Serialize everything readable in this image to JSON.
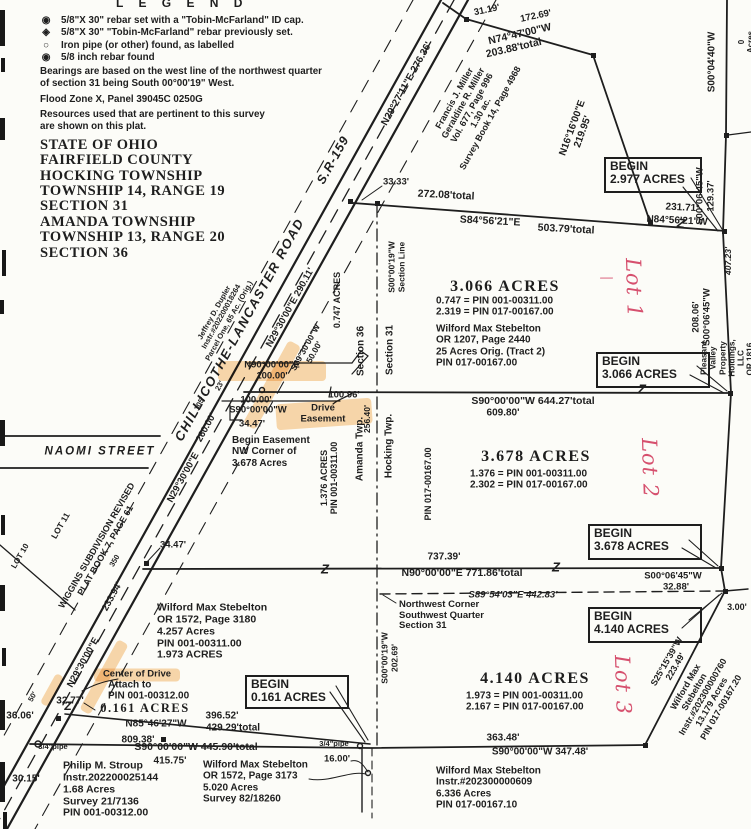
{
  "colors": {
    "paper": "#fcfcf8",
    "ink": "#1e1e1e",
    "red": "#d6506e",
    "highlight": "#f0a23c"
  },
  "legend": {
    "title": "L E G E N D",
    "items": [
      {
        "symbol": "◉",
        "text": "5/8\"X 30\" rebar set with a \"Tobin-McFarland\" ID cap."
      },
      {
        "symbol": "◈",
        "text": "5/8\"X 30\" \"Tobin-McFarland\" rebar previously set."
      },
      {
        "symbol": "○",
        "text": "Iron pipe (or other) found, as labelled"
      },
      {
        "symbol": "◉",
        "text": "5/8 inch rebar found"
      }
    ]
  },
  "notes": {
    "bearings": "Bearings are based on the west line of the northwest quarter\nof section 31 being South 00°00'19\" West.",
    "flood": "Flood Zone X, Panel 39045C 0250G",
    "resources": "Resources used that are pertinent to this survey\nare shown on this plat."
  },
  "title_block": {
    "text": "STATE OF OHIO\nFAIRFIELD COUNTY\nHOCKING TOWNSHIP\nTOWNSHIP 14, RANGE 19\nSECTION 31\nAMANDA TOWNSHIP\nTOWNSHIP 13, RANGE 20\nSECTION 36"
  },
  "map": {
    "begin_boxes": [
      {
        "label": "BEGIN",
        "acres": "2.977 ACRES",
        "x": 604,
        "y": 157,
        "w": 86,
        "h": 30
      },
      {
        "label": "BEGIN",
        "acres": "3.066 ACRES",
        "x": 596,
        "y": 352,
        "w": 102,
        "h": 30
      },
      {
        "label": "BEGIN",
        "acres": "3.678 ACRES",
        "x": 588,
        "y": 524,
        "w": 102,
        "h": 30
      },
      {
        "label": "BEGIN",
        "acres": "4.140 ACRES",
        "x": 588,
        "y": 607,
        "w": 102,
        "h": 30
      },
      {
        "label": "BEGIN",
        "acres": "0.161 ACRES",
        "x": 245,
        "y": 675,
        "w": 92,
        "h": 28
      }
    ],
    "highlights": [
      {
        "x": 272,
        "y": 371,
        "w": 108,
        "h": 20,
        "r": 0
      },
      {
        "x": 272,
        "y": 385,
        "w": 95,
        "h": 14,
        "r": -61
      },
      {
        "x": 324,
        "y": 414,
        "w": 96,
        "h": 26,
        "r": -4
      },
      {
        "x": 137,
        "y": 675,
        "w": 86,
        "h": 13,
        "r": 0
      },
      {
        "x": 104,
        "y": 677,
        "w": 80,
        "h": 12,
        "r": -61
      },
      {
        "x": 52,
        "y": 690,
        "w": 34,
        "h": 9,
        "r": -61
      }
    ],
    "labels": [
      {
        "n": "distance-label",
        "t": "31.19'",
        "x": 487,
        "y": 11,
        "r": -12,
        "s": 9.5
      },
      {
        "n": "distance-label",
        "t": "172.69'",
        "x": 536,
        "y": 17,
        "r": -12,
        "s": 9.5
      },
      {
        "n": "bearing-label",
        "t": "N74°47'00\"W",
        "x": 520,
        "y": 35,
        "r": -13,
        "s": 10.5
      },
      {
        "n": "distance-label",
        "t": "203.88'total",
        "x": 514,
        "y": 49,
        "r": -13,
        "s": 10.5
      },
      {
        "n": "bearing-label",
        "t": "N29°27'11\"E      276.36'",
        "x": 407,
        "y": 84,
        "r": -61,
        "s": 10
      },
      {
        "n": "bearing-label",
        "t": "N16°16'00\"E\n219.95'",
        "x": 578,
        "y": 130,
        "r": -70,
        "s": 10
      },
      {
        "n": "bearing-label",
        "t": "S00°04'40\"W",
        "x": 712,
        "y": 62,
        "r": -90,
        "s": 10
      },
      {
        "n": "partial-label",
        "t": "0 Acres",
        "x": 746,
        "y": 42,
        "r": -90,
        "s": 8
      },
      {
        "n": "owner-parcel-block",
        "t": "Francis J. Miller\nGeraldine R. Miller\nVol. 677, Page 996\n1.30 ac.\nSurvey Book 14, Page 4968",
        "x": 472,
        "y": 108,
        "r": -61,
        "s": 9
      },
      {
        "n": "distance-label",
        "t": "33.33'",
        "x": 396,
        "y": 183,
        "s": 9.5
      },
      {
        "n": "distance-label",
        "t": "272.08'total",
        "x": 446,
        "y": 196,
        "r": 3,
        "s": 10.5
      },
      {
        "n": "bearing-label",
        "t": "S84°56'21\"E",
        "x": 490,
        "y": 222,
        "r": 3,
        "s": 10.5
      },
      {
        "n": "distance-label",
        "t": "503.79'total",
        "x": 566,
        "y": 230,
        "r": 3,
        "s": 10.5
      },
      {
        "n": "distance-label",
        "t": "231.71'",
        "x": 682,
        "y": 208,
        "r": 3,
        "s": 10
      },
      {
        "n": "bearing-label",
        "t": "N84°56'21\"W",
        "x": 677,
        "y": 221,
        "r": 3,
        "s": 10
      },
      {
        "n": "bearing-label",
        "t": "S00°06'45\"W\n129.37'",
        "x": 706,
        "y": 196,
        "r": -90,
        "s": 9.5
      },
      {
        "n": "distance-label",
        "t": "407.23'",
        "x": 729,
        "y": 261,
        "r": -90,
        "s": 8.5,
        "cls": "it"
      },
      {
        "n": "bearing-label",
        "t": "208.06'\nS00°06'45\"W",
        "x": 702,
        "y": 317,
        "r": -90,
        "s": 9.5
      },
      {
        "n": "owner-parcel-block",
        "t": "Pleasant Valley Property Holdings, LLC\nOR 1816, Page 780  103.056 Acres",
        "x": 741,
        "y": 358,
        "r": -90,
        "s": 8.2
      },
      {
        "n": "parcel-acreage",
        "t": "3.066 ACRES",
        "x": 505,
        "y": 287,
        "s": 16,
        "cls": "acre"
      },
      {
        "n": "pin-equation",
        "t": "0.747  =  PIN 001-00311.00\n2.319  =  PIN 017-00167.00",
        "x": 436,
        "y": 307,
        "al": "l",
        "s": 10
      },
      {
        "n": "owner-parcel-block",
        "t": "Wilford Max Stebelton\nOR 1207, Page 2440\n25 Acres Orig. (Tract 2)\nPIN 017-00167.00",
        "x": 436,
        "y": 346,
        "al": "l",
        "s": 10
      },
      {
        "n": "bearing-label",
        "t": "S90°00'00\"W    644.27'total",
        "x": 533,
        "y": 402,
        "s": 10.5
      },
      {
        "n": "distance-label",
        "t": "609.80'",
        "x": 503,
        "y": 413,
        "s": 10
      },
      {
        "n": "distance-label",
        "t": "100.96'",
        "x": 344,
        "y": 396,
        "s": 9.5
      },
      {
        "n": "easement-label",
        "t": "N90°00'00\"E\n100.00'",
        "x": 272,
        "y": 371,
        "s": 9.5
      },
      {
        "n": "easement-label",
        "t": "S29°30'00\"W\n50.00'",
        "x": 310,
        "y": 350,
        "r": -61,
        "s": 8.5
      },
      {
        "n": "distance-label",
        "t": "100.00'",
        "x": 256,
        "y": 401,
        "s": 9.5
      },
      {
        "n": "bearing-label",
        "t": "S90°00'00\"W",
        "x": 258,
        "y": 411,
        "s": 9.5
      },
      {
        "n": "distance-label",
        "t": "34.47'",
        "x": 252,
        "y": 425,
        "s": 9.5
      },
      {
        "n": "easement-label",
        "t": "Drive\nEasement",
        "x": 323,
        "y": 414,
        "s": 9.5
      },
      {
        "n": "begin-easement-note",
        "t": "Begin Easement\nNW Corner of\n3.678 Acres",
        "x": 232,
        "y": 452,
        "al": "l",
        "s": 10
      },
      {
        "n": "acreage-label",
        "t": "0.747 ACRES",
        "x": 337,
        "y": 300,
        "r": -90,
        "s": 9
      },
      {
        "n": "section-label",
        "t": "Section 36",
        "x": 361,
        "y": 351,
        "r": -90,
        "s": 10
      },
      {
        "n": "section-label",
        "t": "Section 31",
        "x": 390,
        "y": 350,
        "r": -90,
        "s": 10
      },
      {
        "n": "section-line-label",
        "t": "S00°00'19\"W\nSection Line",
        "x": 397,
        "y": 267,
        "r": -90,
        "s": 8.5
      },
      {
        "n": "township-label",
        "t": "Amanda Twp.",
        "x": 360,
        "y": 449,
        "r": -90,
        "s": 10
      },
      {
        "n": "township-label",
        "t": "Hocking Twp.",
        "x": 389,
        "y": 446,
        "r": -90,
        "s": 10
      },
      {
        "n": "acreage-label",
        "t": "1.376 ACRES\nPIN 001-00311.00",
        "x": 329,
        "y": 478,
        "r": -90,
        "s": 9
      },
      {
        "n": "distance-label",
        "t": "256.40'",
        "x": 368,
        "y": 419,
        "r": -90,
        "s": 8.5
      },
      {
        "n": "pin-label",
        "t": "PIN 017-00167.00",
        "x": 428,
        "y": 484,
        "r": -90,
        "s": 9
      },
      {
        "n": "parcel-acreage",
        "t": "3.678 ACRES",
        "x": 536,
        "y": 457,
        "s": 16,
        "cls": "acre"
      },
      {
        "n": "pin-equation",
        "t": "1.376  =  PIN 001-00311.00\n2.302  =  PIN 017-00167.00",
        "x": 470,
        "y": 480,
        "al": "l",
        "s": 10
      },
      {
        "n": "distance-label",
        "t": "737.39'",
        "x": 444,
        "y": 557,
        "s": 10
      },
      {
        "n": "bearing-label",
        "t": "N90°00'00\"E    771.86'total",
        "x": 462,
        "y": 574,
        "s": 10.5
      },
      {
        "n": "bearing-label",
        "t": "S00°06'45\"W",
        "x": 673,
        "y": 577,
        "s": 9.5
      },
      {
        "n": "distance-label",
        "t": "32.88'",
        "x": 676,
        "y": 588,
        "s": 9.5
      },
      {
        "n": "bearing-label",
        "t": "S89°54'03\"E    442.83'",
        "x": 513,
        "y": 596,
        "s": 9.5,
        "cls": "it"
      },
      {
        "n": "corner-note",
        "t": "Northwest Corner\nSouthwest Quarter\nSection 31",
        "x": 399,
        "y": 616,
        "al": "l",
        "s": 9.5
      },
      {
        "n": "parcel-acreage",
        "t": "4.140 ACRES",
        "x": 535,
        "y": 679,
        "s": 16,
        "cls": "acre"
      },
      {
        "n": "pin-equation",
        "t": "1.973  =  PIN 001-00311.00\n2.167  =  PIN 017-00167.00",
        "x": 466,
        "y": 702,
        "al": "l",
        "s": 10
      },
      {
        "n": "distance-label",
        "t": "363.48'",
        "x": 503,
        "y": 738,
        "s": 10
      },
      {
        "n": "bearing-label",
        "t": "S90°00'00\"W    347.48'",
        "x": 540,
        "y": 752,
        "s": 10
      },
      {
        "n": "owner-parcel-block",
        "t": "Wilford Max Stebelton\nInstr.#202300000609\n6.336 Acres\nPIN 017-00167.10",
        "x": 436,
        "y": 788,
        "al": "l",
        "s": 10
      },
      {
        "n": "bearing-label",
        "t": "S25°15'39\"W\n223.49'",
        "x": 671,
        "y": 664,
        "r": -60,
        "s": 9
      },
      {
        "n": "owner-parcel-block",
        "t": "Wilford Max Stebelton\nInstr.#202300000760\n13.179 Acres\nPIN 017-00167.20",
        "x": 703,
        "y": 697,
        "r": -60,
        "s": 9
      },
      {
        "n": "distance-label",
        "t": "3.00'",
        "x": 737,
        "y": 607,
        "s": 9
      },
      {
        "n": "distance-label",
        "t": "16.00'",
        "x": 337,
        "y": 760,
        "s": 9.5
      },
      {
        "n": "pipe-label",
        "t": "3/4\"pipe",
        "x": 53,
        "y": 747,
        "s": 7.5
      },
      {
        "n": "pipe-label",
        "t": "3/4\"pipe",
        "x": 334,
        "y": 744,
        "s": 7.5
      },
      {
        "n": "distance-label",
        "t": "36.06'",
        "x": 20,
        "y": 716,
        "s": 10
      },
      {
        "n": "distance-label",
        "t": "30.15'",
        "x": 26,
        "y": 779,
        "s": 10
      },
      {
        "n": "distance-label",
        "t": "32.77'",
        "x": 70,
        "y": 701,
        "s": 10
      },
      {
        "n": "distance-label",
        "t": "809.38'",
        "x": 138,
        "y": 740,
        "s": 10
      },
      {
        "n": "bearing-label",
        "t": "S90°00'00\"W   445.90'total",
        "x": 196,
        "y": 748,
        "s": 10.5
      },
      {
        "n": "distance-label",
        "t": "415.75'",
        "x": 170,
        "y": 761,
        "s": 10
      },
      {
        "n": "bearing-label",
        "t": "N85°46'27\"W",
        "x": 156,
        "y": 724,
        "s": 10
      },
      {
        "n": "distance-label",
        "t": "396.52'",
        "x": 222,
        "y": 716,
        "s": 10
      },
      {
        "n": "distance-label",
        "t": "429.29'total",
        "x": 233,
        "y": 728,
        "s": 10
      },
      {
        "n": "owner-parcel-block",
        "t": "Philip M. Stroup\nInstr.202200025144\n1.68 Acres\nSurvey 21/7136\nPIN 001-00312.00",
        "x": 63,
        "y": 790,
        "al": "l",
        "s": 10.5
      },
      {
        "n": "owner-parcel-block",
        "t": "Wilford Max Stebelton\nOR 1572, Page 3173\n5.020 Acres\nSurvey 82/18260",
        "x": 203,
        "y": 782,
        "al": "l",
        "s": 10
      },
      {
        "n": "drive-note",
        "t": "Center of Drive",
        "x": 137,
        "y": 675,
        "s": 9.5
      },
      {
        "n": "drive-note",
        "t": "Attach to\nPIN 001-00312.00",
        "x": 108,
        "y": 691,
        "al": "l",
        "s": 10
      },
      {
        "n": "parcel-acreage",
        "t": "0.161 ACRES",
        "x": 145,
        "y": 708,
        "s": 12.5,
        "cls": "acre"
      },
      {
        "n": "street-name",
        "t": "NAOMI STREET",
        "x": 100,
        "y": 452,
        "s": 11.5,
        "cls": "it",
        "ls": 2
      },
      {
        "n": "lot-label",
        "t": "LOT 11",
        "x": 61,
        "y": 526,
        "r": -60,
        "s": 8.5
      },
      {
        "n": "subdivision-label",
        "t": "WIGGINS SUBDIVISION REVISED\nPLAT BOOK 7, PAGE 61",
        "x": 101,
        "y": 548,
        "r": -60,
        "s": 9
      },
      {
        "n": "lot-label",
        "t": "LOT 10",
        "x": 20,
        "y": 556,
        "r": -60,
        "s": 8
      },
      {
        "n": "distance-label",
        "t": "350",
        "x": 115,
        "y": 561,
        "r": -60,
        "s": 7.5
      },
      {
        "n": "distance-label",
        "t": "34.47'",
        "x": 173,
        "y": 546,
        "s": 9.5
      },
      {
        "n": "owner-parcel-block",
        "t": "Wilford Max Stebelton\nOR 1572, Page 3180\n4.257 Acres\nPIN 001-00311.00\n    1.973 ACRES",
        "x": 157,
        "y": 632,
        "al": "l",
        "s": 10.5
      },
      {
        "n": "road-name",
        "t": "CHILLICOTHE-LANCASTER ROAD",
        "x": 240,
        "y": 330,
        "r": -61,
        "s": 13,
        "cls": "it",
        "ls": 1.5
      },
      {
        "n": "road-name",
        "t": "S.R-159",
        "x": 333,
        "y": 160,
        "r": -61,
        "s": 12.5,
        "cls": "it",
        "ls": 1
      },
      {
        "n": "bearing-label",
        "t": "N29°30'00\"E   290.11'",
        "x": 291,
        "y": 308,
        "r": -61,
        "s": 9.5
      },
      {
        "n": "distance-label",
        "t": "260.00'",
        "x": 207,
        "y": 428,
        "r": -61,
        "s": 9.5
      },
      {
        "n": "bearing-label",
        "t": "N29°30'00\"E",
        "x": 184,
        "y": 478,
        "r": -61,
        "s": 9.5
      },
      {
        "n": "distance-label",
        "t": "233.94'",
        "x": 113,
        "y": 597,
        "r": -61,
        "s": 9.5
      },
      {
        "n": "bearing-label",
        "t": "N29°30'00\"E",
        "x": 84,
        "y": 663,
        "r": -61,
        "s": 9.5
      },
      {
        "n": "distance-label",
        "t": "50'",
        "x": 33,
        "y": 697,
        "r": -61,
        "s": 7.5
      },
      {
        "n": "distance-label",
        "t": "105'",
        "x": 200,
        "y": 404,
        "r": -61,
        "s": 7.5
      },
      {
        "n": "distance-label",
        "t": "23'",
        "x": 220,
        "y": 386,
        "r": -61,
        "s": 7.5
      },
      {
        "n": "owner-parcel-block",
        "t": "Jeffrey D. Dupler\nInstr.#202200018264\nParcel One, 65 Ac. (Orig.)",
        "x": 222,
        "y": 317,
        "r": -61,
        "s": 7.5
      },
      {
        "n": "section-line-label",
        "t": "S00°00'19\"W\n202.69'",
        "x": 390,
        "y": 658,
        "r": -90,
        "s": 8.5
      },
      {
        "n": "lot-annotation-red",
        "t": "Lot 1",
        "x": 633,
        "y": 288,
        "r": 88,
        "s": 21,
        "cls": "hand"
      },
      {
        "n": "lot-annotation-red",
        "t": "Lot 2",
        "x": 649,
        "y": 468,
        "r": 88,
        "s": 21,
        "cls": "hand"
      },
      {
        "n": "lot-annotation-red",
        "t": "Lot 3",
        "x": 622,
        "y": 685,
        "r": 88,
        "s": 21,
        "cls": "hand"
      },
      {
        "n": "lot-annotation-red",
        "t": "—",
        "x": 607,
        "y": 279,
        "s": 14,
        "cls": "hand"
      },
      {
        "n": "line-break-symbol",
        "t": "Z",
        "x": 681,
        "y": 224,
        "r": 8,
        "s": 13,
        "cls": "brk"
      },
      {
        "n": "line-break-symbol",
        "t": "Z",
        "x": 642,
        "y": 390,
        "s": 13,
        "cls": "brk"
      },
      {
        "n": "line-break-symbol",
        "t": "Z",
        "x": 556,
        "y": 568,
        "s": 13,
        "cls": "brk"
      },
      {
        "n": "line-break-symbol",
        "t": "Z",
        "x": 325,
        "y": 570,
        "s": 13,
        "cls": "brk"
      },
      {
        "n": "line-break-symbol",
        "t": "Z",
        "x": 68,
        "y": 707,
        "s": 12,
        "cls": "brk"
      }
    ]
  }
}
